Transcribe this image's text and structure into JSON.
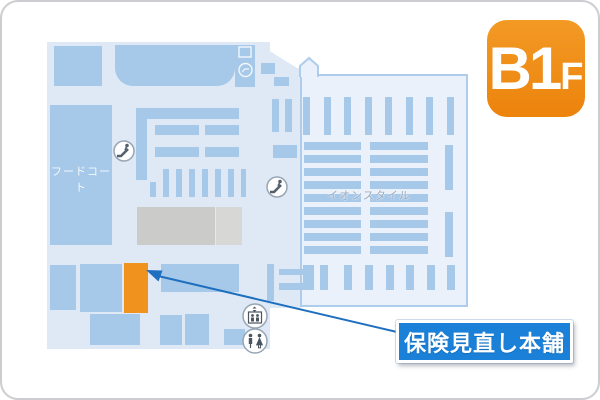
{
  "page": {
    "border_color": "#cbcdd0",
    "background": "#ffffff"
  },
  "floor_badge": {
    "main": "B1",
    "suffix": "F",
    "color": "#ee8a14",
    "text_color": "#ffffff"
  },
  "map": {
    "bg_color": "#dfe9f6",
    "block_color": "#a6c8e9",
    "store_area_fill": "#eaf1fa",
    "store_area_outline": "#aecdec",
    "labels": {
      "food_court": "フードコート",
      "anchor_store": "イオンスタイル"
    },
    "highlight": {
      "color": "#f0921e",
      "store_name": "保険見直し本舗"
    },
    "icons": [
      "escalator-icon",
      "escalator-icon",
      "cart-station-icon",
      "elevator-icon",
      "restroom-icon"
    ]
  },
  "callout": {
    "label": "保険見直し本舗",
    "bg_color": "#1a80d8",
    "border_color": "#ffffff",
    "arrow_color": "#1f6fc0"
  }
}
